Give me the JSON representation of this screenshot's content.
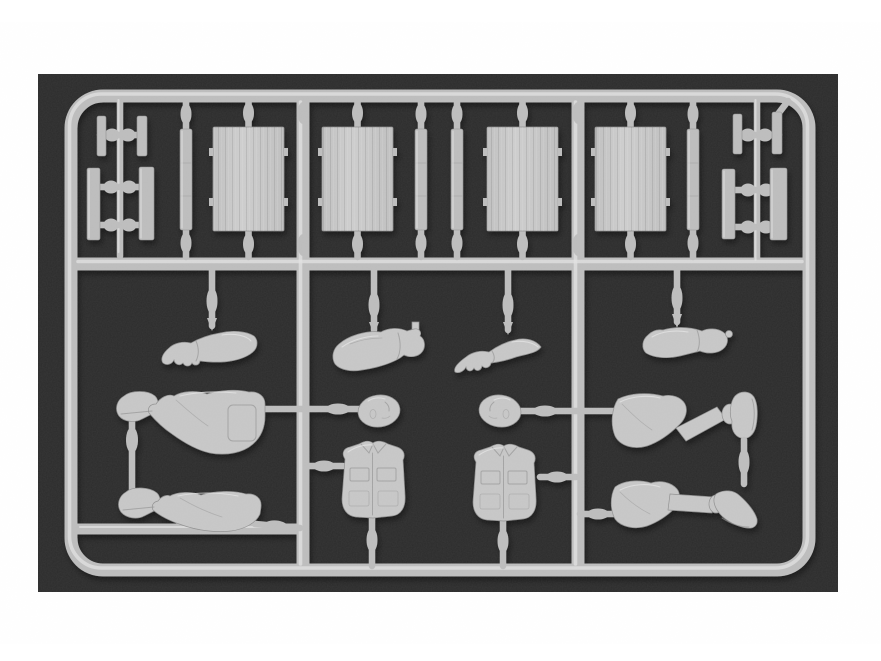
{
  "scene": {
    "subject": "Photograph of an unpainted light-grey injection-molded plastic model sprue holding scale figure parts (arms, hands, heads, shirt torsos, booted trouser legs) and flat wood-grain panels and planks, shot on a dark background with white margins",
    "style": "photograph",
    "text_visible": "none"
  },
  "colors": {
    "page_background": "#ffffff",
    "photo_background": "#2b2b2b",
    "plastic_base": "#bcbcbc",
    "plastic_highlight": "#e2e2e2",
    "plastic_shadow": "#8f8f8f",
    "plastic_part": "#c6c6c6",
    "panel_light": "#cdcdcd",
    "panel_dark": "#bfbfbf"
  },
  "parts": {
    "frame": "rectangular sprue frame with centre rail",
    "clusters": [
      "small plank-and-fitting cluster (top left)",
      "small plank-and-fitting cluster (top right)"
    ],
    "strips": [
      "narrow plank strip 1",
      "narrow plank strip 2",
      "narrow plank strip 3",
      "narrow plank strip 4"
    ],
    "panels": [
      "wood-grain panel 1",
      "wood-grain panel 2",
      "wood-grain panel 3",
      "wood-grain panel 4"
    ],
    "arms": [
      "arm with open hand (left)",
      "arm with clenched fist, thumb up",
      "hand with spread fingers",
      "rolled-sleeve arm with fist"
    ],
    "heads": [
      "figure head (left)",
      "figure head (right)"
    ],
    "torsos": [
      "shirt torso with chest pockets (left)",
      "shirt torso with chest pockets (right)"
    ],
    "legs": [
      "booted trouser leg (upper left)",
      "bent trouser leg with raised boot (upper right)",
      "booted trouser leg (lower left)",
      "trouser leg with boot (lower right)"
    ]
  }
}
